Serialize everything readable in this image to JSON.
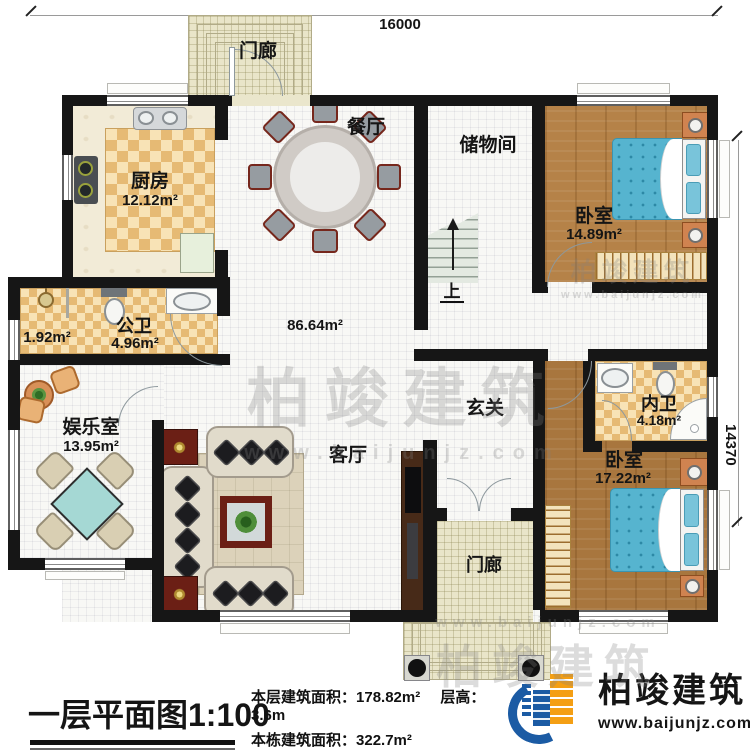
{
  "dimensions": {
    "width": "16000",
    "height": "14370"
  },
  "rooms": {
    "porch_top": {
      "name": "门廊"
    },
    "kitchen": {
      "name": "厨房",
      "area": "12.12m²"
    },
    "dining": {
      "name": "餐厅"
    },
    "storage": {
      "name": "储物间"
    },
    "bedroom1": {
      "name": "卧室",
      "area": "14.89m²"
    },
    "shower_room": {
      "area": "1.92m²"
    },
    "public_bath": {
      "name": "公卫",
      "area": "4.96m²"
    },
    "open_area": {
      "area": "86.64m²"
    },
    "entertainment": {
      "name": "娱乐室",
      "area": "13.95m²"
    },
    "living": {
      "name": "客厅"
    },
    "foyer": {
      "name": "玄关"
    },
    "private_bath": {
      "name": "内卫",
      "area": "4.18m²"
    },
    "bedroom2": {
      "name": "卧室",
      "area": "17.22m²"
    },
    "porch_bottom": {
      "name": "门廊"
    },
    "stairs": {
      "up": "上"
    }
  },
  "watermark": {
    "brand": "柏竣建筑",
    "site": "www.baijunjz.com"
  },
  "footer": {
    "title": "一层平面图1:100",
    "stats": [
      {
        "label": "本层建筑面积：",
        "value": "178.82m²"
      },
      {
        "label": "本栋建筑面积：",
        "value": "322.7m²"
      },
      {
        "label": "占地面积：",
        "value": "180m²"
      }
    ],
    "height_label": "层高：",
    "height_value": "3.6m",
    "brand": "柏竣建筑",
    "site": "www.baijunjz.com"
  },
  "colors": {
    "wall": "#161616",
    "tile_accent": "#e6ba74",
    "wood": "#b58248",
    "bed": "#56b4cf",
    "brand_blue": "#1b5ba4",
    "brand_orange": "#f49f14"
  }
}
